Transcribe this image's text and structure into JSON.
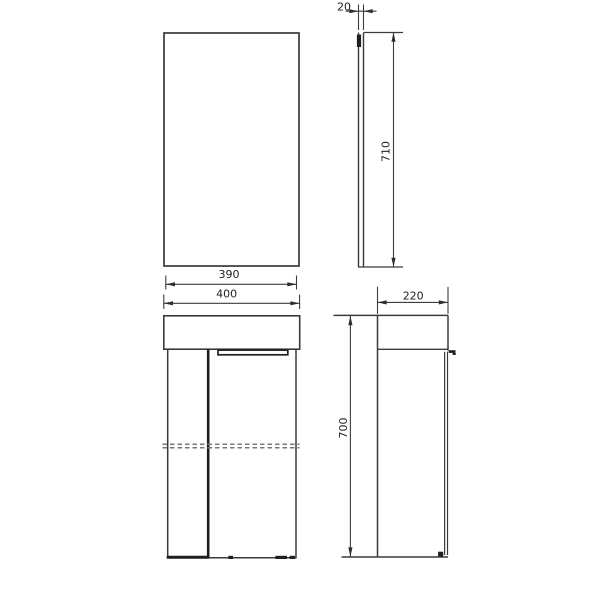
{
  "drawing": {
    "background": "#ffffff",
    "line_color": "#3a3a3a",
    "hidden_line_color": "#787878",
    "text_color": "#1f1f1f",
    "views": {
      "mirror_front": {
        "name": "mirror cabinet front view"
      },
      "mirror_side": {
        "name": "mirror cabinet side view",
        "thickness_label": "20",
        "height_label": "710"
      },
      "cabinet_front": {
        "name": "vanity cabinet front view",
        "inner_width_label": "390",
        "width_label": "400"
      },
      "cabinet_side": {
        "name": "vanity cabinet side view",
        "depth_label": "220",
        "height_label": "700"
      }
    }
  }
}
